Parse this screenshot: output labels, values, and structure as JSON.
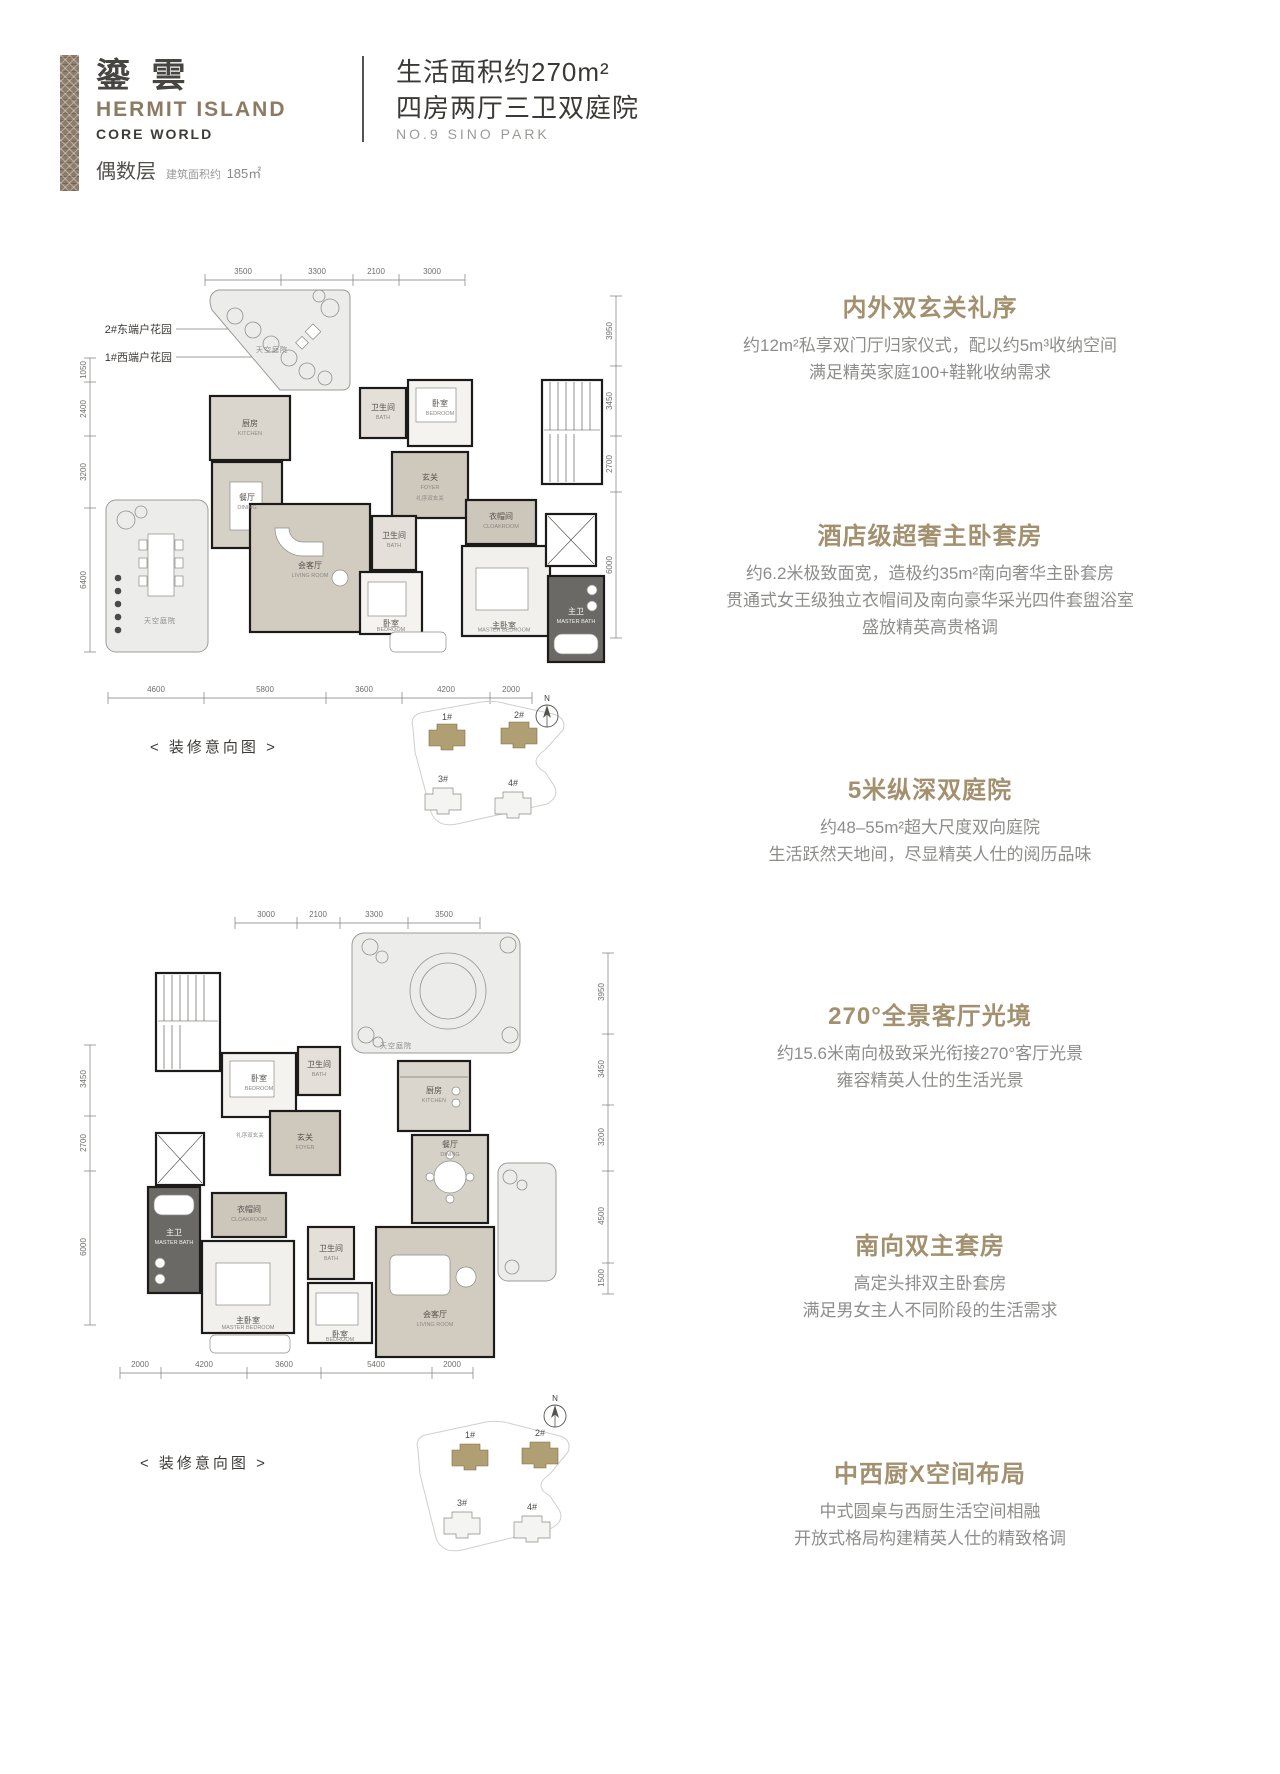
{
  "header": {
    "brand_cn": "鎏 雲",
    "brand_en": "HERMIT ISLAND",
    "brand_sub": "CORE WORLD",
    "floor_label": "偶数层",
    "area_label": "建筑面积约",
    "area_value": "185㎡",
    "title_line1": "生活面积约270m²",
    "title_line2": "四房两厅三卫双庭院",
    "title_line3": "NO.9 SINO PARK"
  },
  "features": [
    {
      "heading": "内外双玄关礼序",
      "line1": "约12m²私享双门厅归家仪式，配以约5m³收纳空间",
      "line2": "满足精英家庭100+鞋靴收纳需求",
      "line3": ""
    },
    {
      "heading": "酒店级超奢主卧套房",
      "line1": "约6.2米极致面宽，造极约35m²南向奢华主卧套房",
      "line2": "贯通式女王级独立衣帽间及南向豪华采光四件套盥浴室",
      "line3": "盛放精英高贵格调"
    },
    {
      "heading": "5米纵深双庭院",
      "line1": "约48–55m²超大尺度双向庭院",
      "line2": "生活跃然天地间，尽显精英人仕的阅历品味",
      "line3": ""
    },
    {
      "heading": "270°全景客厅光境",
      "line1": "约15.6米南向极致采光衔接270°客厅光景",
      "line2": "雍容精英人仕的生活光景",
      "line3": ""
    },
    {
      "heading": "南向双主套房",
      "line1": "高定头排双主卧套房",
      "line2": "满足男女主人不同阶段的生活需求",
      "line3": ""
    },
    {
      "heading": "中西厨X空间布局",
      "line1": "中式圆桌与西厨生活空间相融",
      "line2": "开放式格局构建精英人仕的精致格调",
      "line3": ""
    }
  ],
  "site": {
    "north": "N",
    "b1": "1#",
    "b2": "2#",
    "b3": "3#",
    "b4": "4#"
  },
  "plans": {
    "upper": {
      "callout_east": "2#东端户花园",
      "callout_west": "1#西端户花园",
      "caption": "< 装修意向图 >",
      "dims_top": [
        "3500",
        "3300",
        "2100",
        "3000"
      ],
      "dims_left": [
        "1050",
        "2400",
        "3200",
        "6400"
      ],
      "dims_right": [
        "3950",
        "3450",
        "2700",
        "6000"
      ],
      "dims_bottom": [
        "4600",
        "5800",
        "3600",
        "4200",
        "2000"
      ],
      "rooms": {
        "kitchen_cn": "厨房",
        "kitchen_en": "KITCHEN",
        "bath_top_cn": "卫生间",
        "bath_top_en": "BATH",
        "bedroom_top_cn": "卧室",
        "bedroom_top_en": "BEDROOM",
        "foyer_cn": "玄关",
        "foyer_en": "FOYER",
        "foyer_note": "礼序双玄关",
        "dining_cn": "餐厅",
        "dining_en": "DINING",
        "living_cn": "会客厅",
        "living_en": "LIVING ROOM",
        "bath_mid_cn": "卫生间",
        "bath_mid_en": "BATH",
        "bedroom_mid_cn": "卧室",
        "bedroom_mid_en": "BEDROOM",
        "cloakroom_cn": "衣帽间",
        "cloakroom_en": "CLOAKROOM",
        "master_bedroom_cn": "主卧室",
        "master_bedroom_en": "MASTER BEDROOM",
        "master_bath_cn": "主卫",
        "master_bath_en": "MASTER BATH",
        "garden_top": "天空庭院",
        "garden_left": "天空庭院"
      }
    },
    "lower": {
      "caption": "< 装修意向图 >",
      "dims_top": [
        "3000",
        "2100",
        "3300",
        "3500"
      ],
      "dims_left": [
        "3450",
        "2700",
        "6000"
      ],
      "dims_right": [
        "3950",
        "3450",
        "3200",
        "4500",
        "1500"
      ],
      "dims_bottom": [
        "2000",
        "4200",
        "3600",
        "5400",
        "2000"
      ],
      "rooms": {
        "kitchen_cn": "厨房",
        "kitchen_en": "KITCHEN",
        "bath_top_cn": "卫生间",
        "bath_top_en": "BATH",
        "bedroom_top_cn": "卧室",
        "bedroom_top_en": "BEDROOM",
        "foyer_cn": "玄关",
        "foyer_en": "FOYER",
        "foyer_note": "礼序双玄关",
        "dining_cn": "餐厅",
        "dining_en": "DINING",
        "living_cn": "会客厅",
        "living_en": "LIVING ROOM",
        "bath_mid_cn": "卫生间",
        "bath_mid_en": "BATH",
        "bedroom_mid_cn": "卧室",
        "bedroom_mid_en": "BEDROOM",
        "cloakroom_cn": "衣帽间",
        "cloakroom_en": "CLOAKROOM",
        "master_bedroom_cn": "主卧室",
        "master_bedroom_en": "MASTER BEDROOM",
        "master_bath_cn": "主卫",
        "master_bath_en": "MASTER BATH",
        "garden_top": "天空庭院"
      }
    }
  }
}
